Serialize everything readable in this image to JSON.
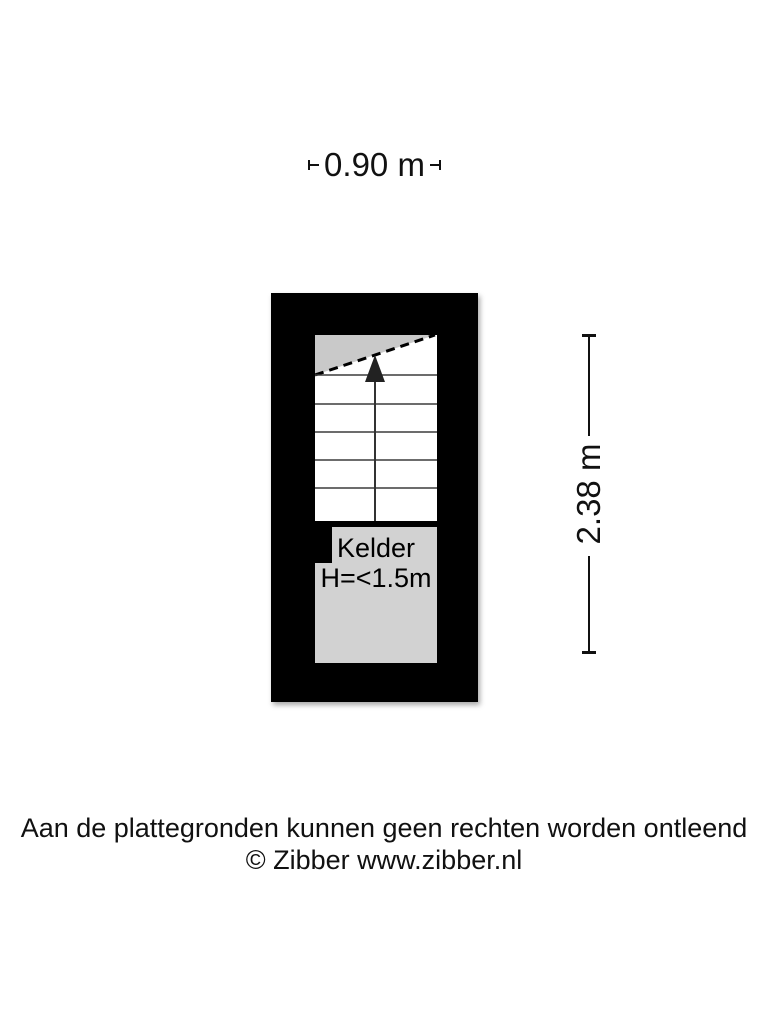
{
  "dimensions": {
    "width_label": "0.90 m",
    "height_label": "2.38 m"
  },
  "room": {
    "name": "Kelder",
    "height_note": "H=<1.5m"
  },
  "footer": {
    "line1": "Aan de plattegronden kunnen geen rechten worden ontleend",
    "line2": "© Zibber www.zibber.nl"
  },
  "colors": {
    "wall": "#000000",
    "stair_fill": "#ffffff",
    "room_fill": "#d2d2d2",
    "landing_fill": "#c9c9c9",
    "stair_tread": "#3c3c3c",
    "arrow": "#222222",
    "text": "#111111",
    "background": "#ffffff"
  }
}
